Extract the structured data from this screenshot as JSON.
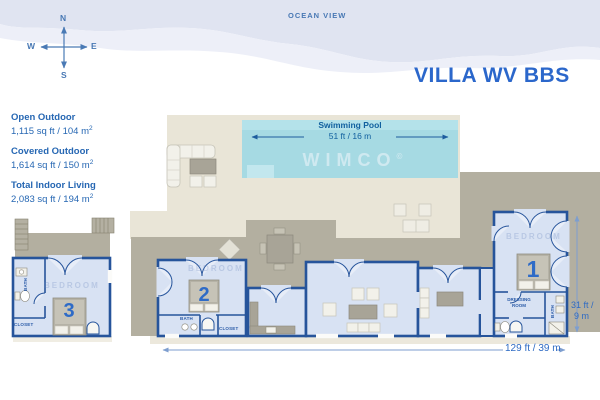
{
  "header": {
    "ocean_label": "OCEAN VIEW",
    "title": "VILLA WV BBS"
  },
  "compass": {
    "n": "N",
    "s": "S",
    "e": "E",
    "w": "W"
  },
  "stats": [
    {
      "label": "Open Outdoor",
      "value": "1,115 sq ft / 104 m",
      "sup": "2"
    },
    {
      "label": "Covered Outdoor",
      "value": "1,614 sq ft / 150 m",
      "sup": "2"
    },
    {
      "label": "Total Indoor Living",
      "value": "2,083 sq ft / 194 m",
      "sup": "2"
    }
  ],
  "pool": {
    "label": "Swimming Pool",
    "dimension": "51 ft / 16 m"
  },
  "watermark": {
    "brand": "WIMCO",
    "mark": "©"
  },
  "dimensions": {
    "width": "129 ft / 39 m",
    "height_top": "31 ft /",
    "height_bottom": "9 m"
  },
  "rooms": {
    "bedroom1": {
      "number": "1",
      "name": "BEDROOM",
      "dressing1": "DRESSING",
      "dressing2": "ROOM",
      "bath": "BATH"
    },
    "bedroom2": {
      "number": "2",
      "name": "BEDROOM",
      "bath": "BATH",
      "closet": "CLOSET"
    },
    "bedroom3": {
      "number": "3",
      "name": "BEDROOM",
      "bath": "BATH",
      "closet": "CLOSET"
    }
  },
  "colors": {
    "accent": "#2b67cb",
    "wall": "#26549b",
    "room_fill": "#d8e2f3",
    "pool": "#a6dae3",
    "deck": "#b3afa0",
    "terrace": "#e9e5d7",
    "ocean": "#e0e4f1"
  }
}
